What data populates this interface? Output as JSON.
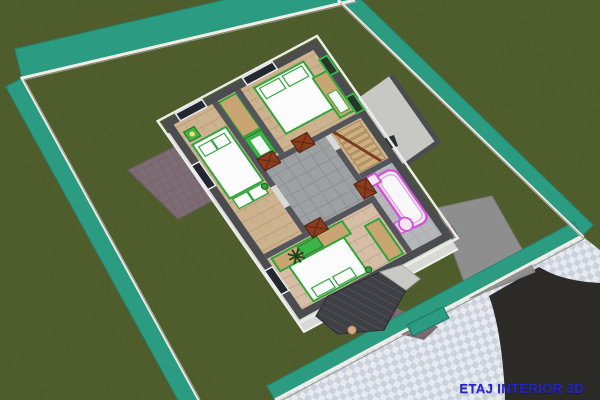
{
  "title": {
    "text": "ETAJ INTERIOR 3D",
    "color": "#2424cc"
  },
  "palette": {
    "grass": "#5a6a33",
    "hedge": "#2b9b82",
    "fence_wall": "#efeee6",
    "sidewalk_light": "#e7eaef",
    "sidewalk_dark": "#ccd2dd",
    "road": "#2b2a27",
    "driveway": "#8e8e8e",
    "pavers": "#7e6c74",
    "wall_top": "#4b4c50",
    "wall_face": "#d9d9d5",
    "wood_floor": "#cdb28e",
    "master_floor": "#d6bda6",
    "hall_tile": "#9ea1a3",
    "bath_floor": "#b5b7ba",
    "furniture_green": "#2ea53a",
    "wardrobe_wood": "#c8a571",
    "door_brown": "#8a3c1e",
    "stair_wood": "#cfae7e",
    "bath_fixture": "#d453d8",
    "roof_dark": "#3e4045",
    "window_dark": "#232830"
  },
  "yard": {
    "features": [
      "lawn",
      "perimeter-hedge",
      "fence-wall",
      "paved-sidewalk",
      "asphalt-road",
      "driveway",
      "driveway-gate",
      "pedestrian-gate",
      "stone-patio",
      "garden-walkway"
    ]
  },
  "house": {
    "level": "upper-floor-cutaway",
    "rooms": [
      {
        "name": "bedroom-1",
        "floor": "wood",
        "furniture": [
          "double-bed",
          "pillows",
          "drawer-units",
          "nightstand",
          "lamp"
        ]
      },
      {
        "name": "closet",
        "floor": "wood",
        "furniture": [
          "wardrobe-cabinets"
        ]
      },
      {
        "name": "bedroom-2",
        "floor": "wood",
        "furniture": [
          "double-bed",
          "pillows",
          "wardrobe"
        ]
      },
      {
        "name": "hallway",
        "floor": "gray-tile",
        "furniture": [
          "doors"
        ]
      },
      {
        "name": "staircase",
        "floor": "wood",
        "furniture": [
          "stairs",
          "handrail"
        ]
      },
      {
        "name": "bathroom",
        "floor": "gray-tile",
        "furniture": [
          "bathtub",
          "toilet",
          "sink"
        ]
      },
      {
        "name": "master-bedroom",
        "floor": "wood",
        "furniture": [
          "double-bed",
          "pillows",
          "wardrobe-row",
          "tv-unit",
          "dresser",
          "ceiling-fan"
        ]
      }
    ],
    "exterior": [
      "terrace",
      "chimney",
      "porch-roof",
      "windows",
      "green-vent-windows"
    ]
  }
}
